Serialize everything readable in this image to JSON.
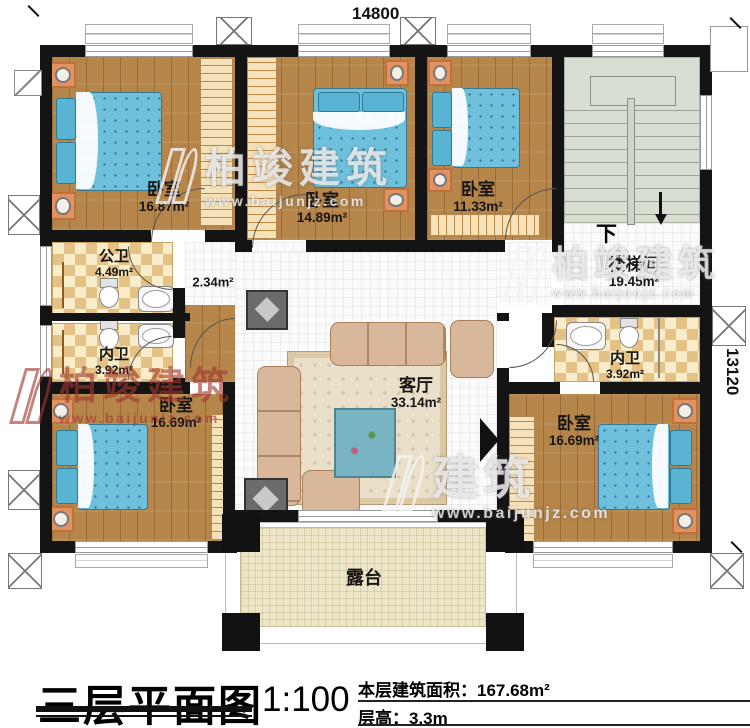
{
  "meta": {
    "plan_title": "三层平面图",
    "scale": "1:100",
    "area_label": "本层建筑面积：",
    "area_value": "167.68m²",
    "floor_height_label": "层高：",
    "floor_height_value": "3.3m"
  },
  "dimensions": {
    "top": "14800",
    "right": "13120"
  },
  "rooms": {
    "bedroom_top_left": {
      "name": "卧室",
      "area": "16.87m²"
    },
    "bedroom_top_middle": {
      "name": "卧室",
      "area": "14.89m²"
    },
    "bedroom_top_right": {
      "name": "卧室",
      "area": "11.33m²"
    },
    "stairwell": {
      "name": "楼梯间",
      "area": "19.45m²",
      "direction": "下"
    },
    "public_bath": {
      "name": "公卫",
      "area": "4.49m²"
    },
    "ensuite_left": {
      "name": "内卫",
      "area": "3.92m²"
    },
    "hallway": {
      "area": "2.34m²"
    },
    "bedroom_bottom_left": {
      "name": "卧室",
      "area": "16.69m²"
    },
    "living_room": {
      "name": "客厅",
      "area": "33.14m²"
    },
    "ensuite_right": {
      "name": "内卫",
      "area": "3.92m²"
    },
    "bedroom_bottom_right": {
      "name": "卧室",
      "area": "16.69m²"
    },
    "terrace": {
      "name": "露台"
    }
  },
  "watermark": {
    "brand": "柏竣建筑",
    "brand_short": "建筑",
    "url": "www.baijunjz.com"
  },
  "colors": {
    "wall": "#141414",
    "wood_floor": "#b5854a",
    "bath_tile": "#e4c184",
    "bed": "#6ec0dc",
    "stairs": "#d9ded3",
    "terrace": "#ede5c8",
    "watermark_red": "#a2372f",
    "nightstand": "#e2925f"
  }
}
